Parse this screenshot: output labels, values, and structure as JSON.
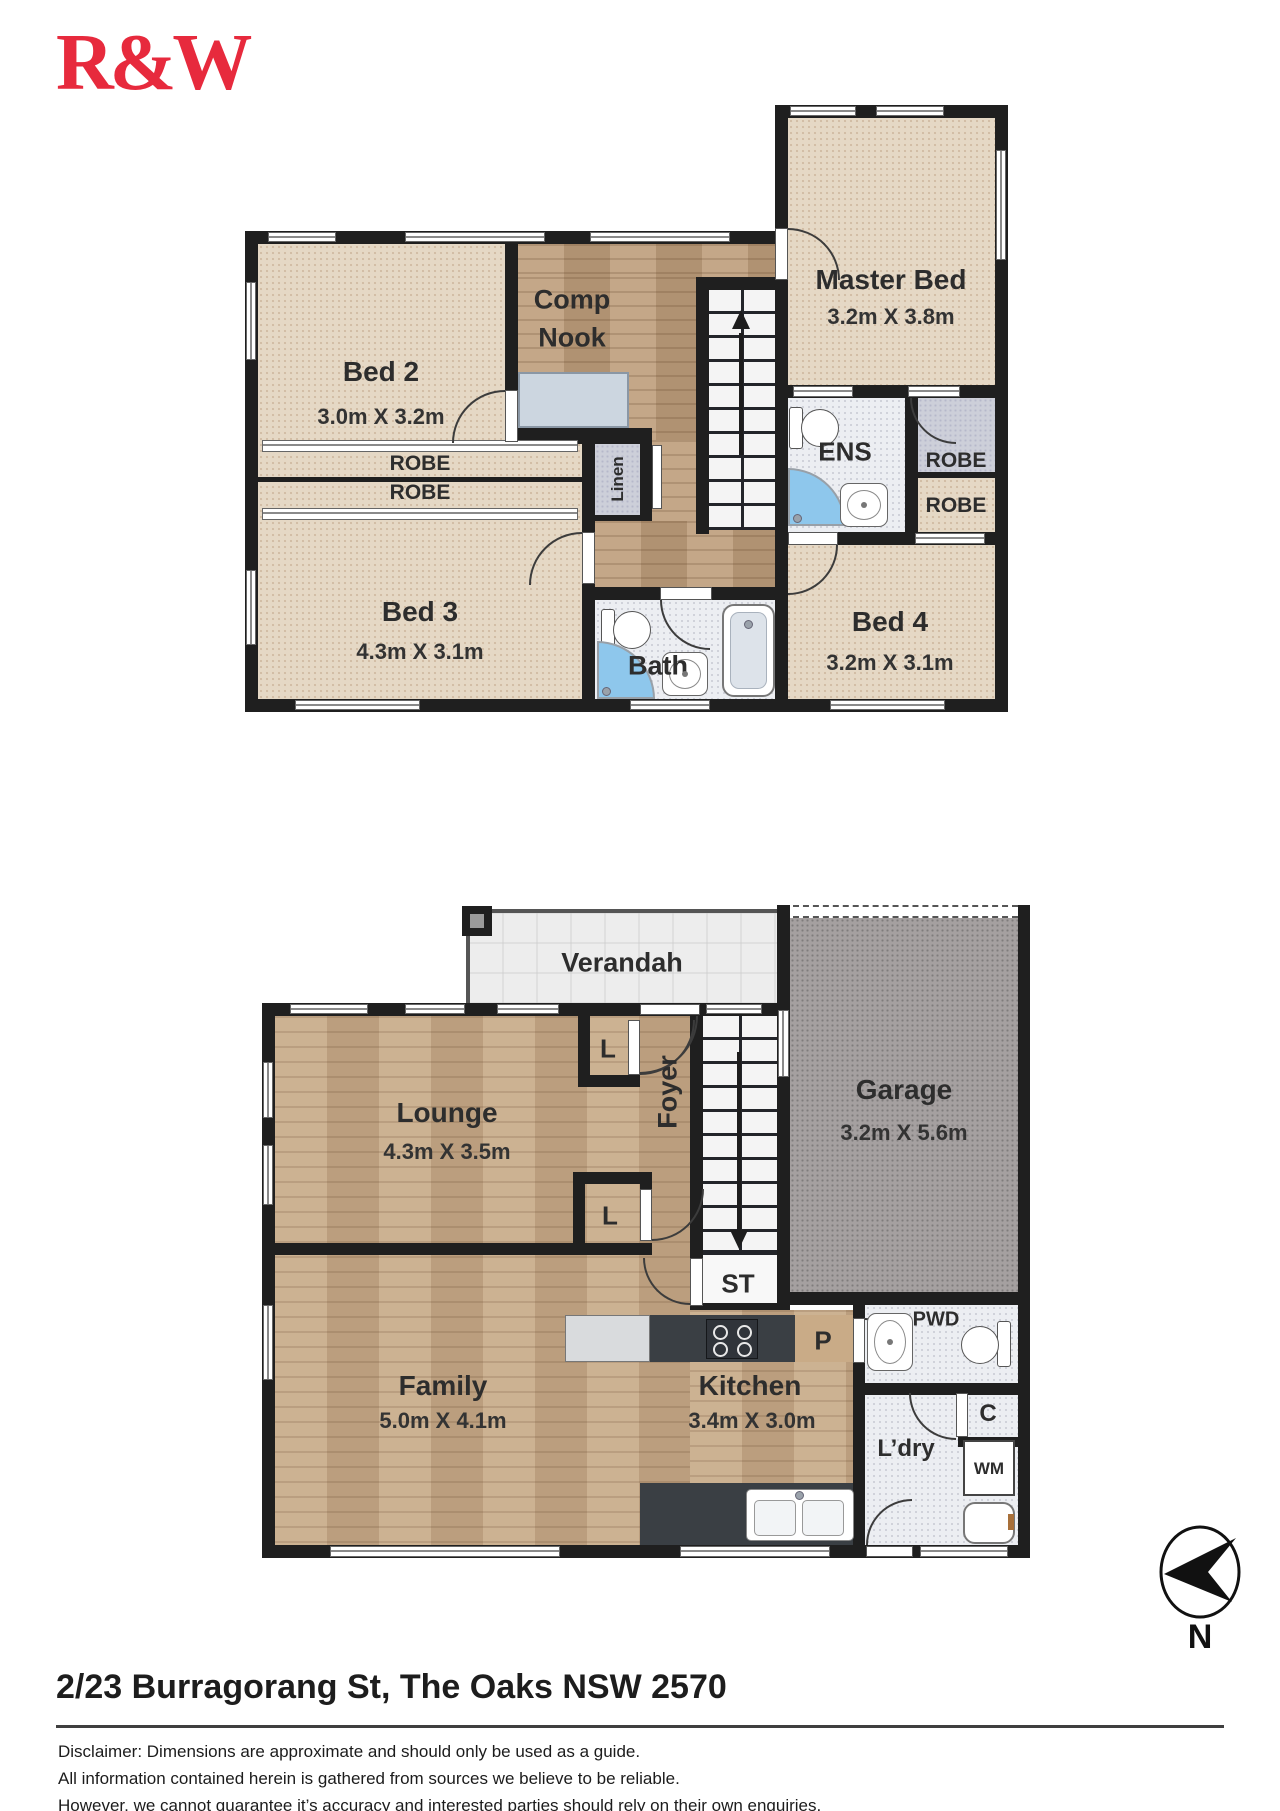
{
  "logo": {
    "text": "R&W",
    "color": "#e72a3d"
  },
  "upper_floor": {
    "bed2": {
      "name": "Bed 2",
      "dims": "3.0m X 3.2m"
    },
    "comp_nook": {
      "line1": "Comp",
      "line2": "Nook"
    },
    "master_bed": {
      "name": "Master Bed",
      "dims": "3.2m X 3.8m"
    },
    "ens": {
      "name": "ENS"
    },
    "robe_right_upper": {
      "name": "ROBE"
    },
    "robe_right_lower": {
      "name": "ROBE"
    },
    "robe_bed2": {
      "name": "ROBE"
    },
    "robe_bed3": {
      "name": "ROBE"
    },
    "linen": {
      "name": "Linen"
    },
    "bed3": {
      "name": "Bed 3",
      "dims": "4.3m X 3.1m"
    },
    "bath": {
      "name": "Bath"
    },
    "bed4": {
      "name": "Bed 4",
      "dims": "3.2m X 3.1m"
    }
  },
  "lower_floor": {
    "verandah": {
      "name": "Verandah"
    },
    "lounge": {
      "name": "Lounge",
      "dims": "4.3m X 3.5m"
    },
    "foyer": {
      "name": "Foyer"
    },
    "garage": {
      "name": "Garage",
      "dims": "3.2m X 5.6m"
    },
    "linen_foyer": {
      "name": "L"
    },
    "linen_lounge": {
      "name": "L"
    },
    "storage": {
      "name": "ST"
    },
    "family": {
      "name": "Family",
      "dims": "5.0m X 4.1m"
    },
    "kitchen": {
      "name": "Kitchen",
      "dims": "3.4m X 3.0m"
    },
    "pantry": {
      "name": "P"
    },
    "powder": {
      "name": "PWD"
    },
    "cupboard": {
      "name": "C"
    },
    "laundry": {
      "name": "L’dry"
    },
    "washing_machine": {
      "name": "WM"
    }
  },
  "footer": {
    "address": "2/23 Burragorang St, The Oaks NSW 2570",
    "disclaimer_line1": "Disclaimer: Dimensions are approximate and should only be used as a guide.",
    "disclaimer_line2": "All information contained herein is gathered from sources we believe to be reliable.",
    "disclaimer_line3": "However, we cannot guarantee it’s accuracy and interested parties should rely on their own enquiries.",
    "compass_label": "N"
  }
}
